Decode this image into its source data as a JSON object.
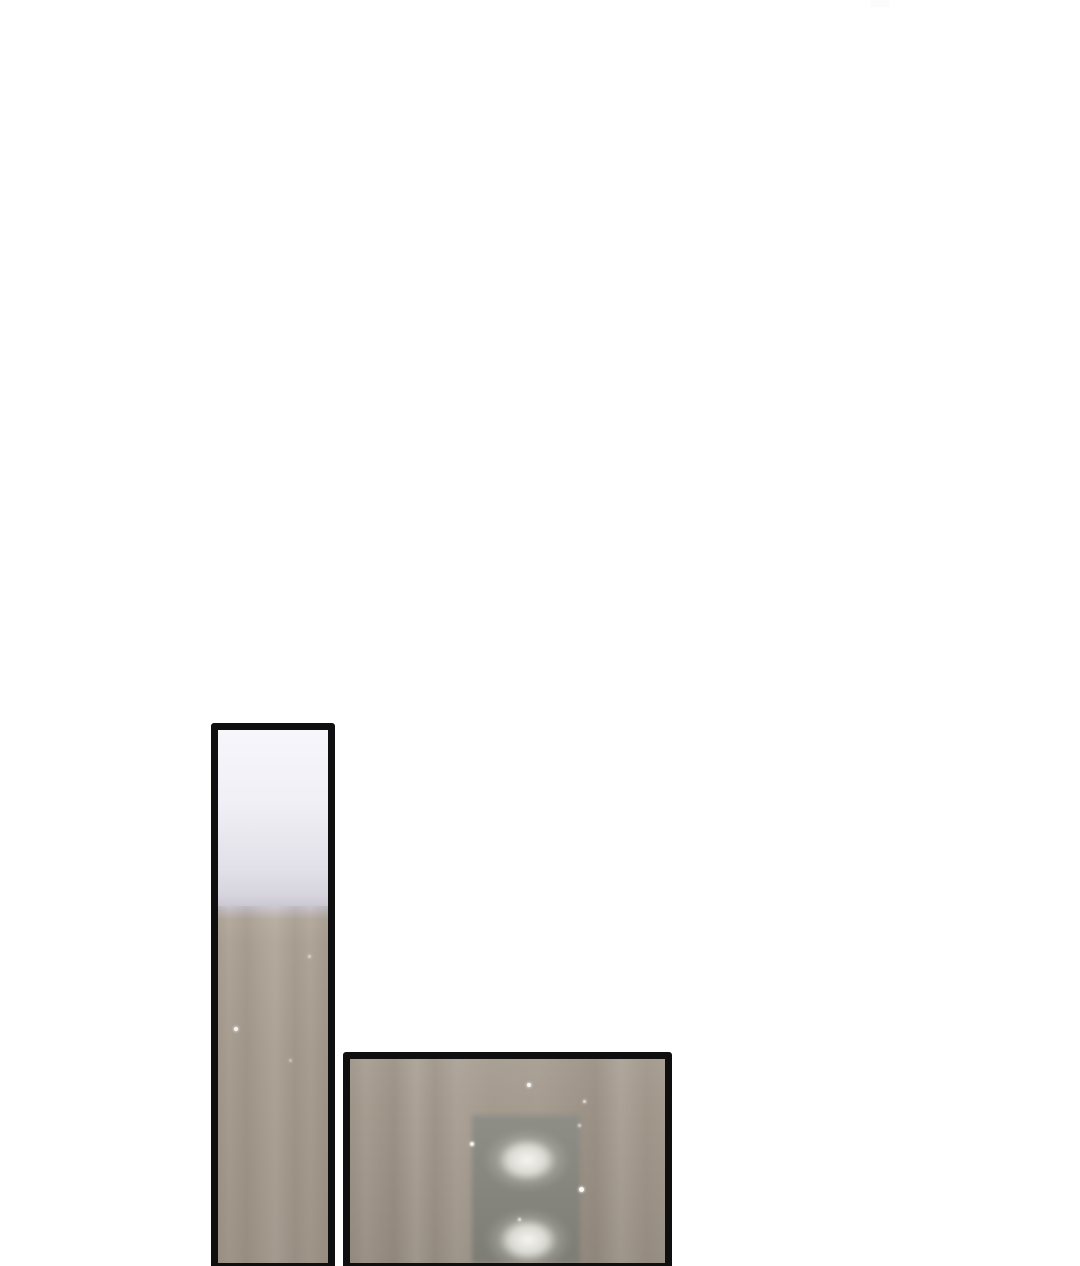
{
  "page": {
    "kind_label": "comic page",
    "background_note": "blank white page, panels bottom-aligned"
  },
  "colors": {
    "page_bg": "#ffffff",
    "panel_border": "#0f0f0f",
    "haze_top": "#f7f6fb",
    "haze_mid": "#d6d4dc",
    "wall_taupe": "#a99f92",
    "wall_taupe_dark": "#a0968a",
    "wood_wall": "#a89e92",
    "button_plate": "#87877f",
    "glow": "#f5f4ef",
    "sparkle": "#ffffff",
    "artifact": "#fbfbfb"
  },
  "panels": [
    {
      "name": "tall-hallway-panel",
      "description": "tall narrow comic panel: pale hazy light above a taupe wall"
    },
    {
      "name": "elevator-door-panel",
      "description": "wide comic panel: wood wall with blurred gray plate and two glowing lights"
    }
  ]
}
